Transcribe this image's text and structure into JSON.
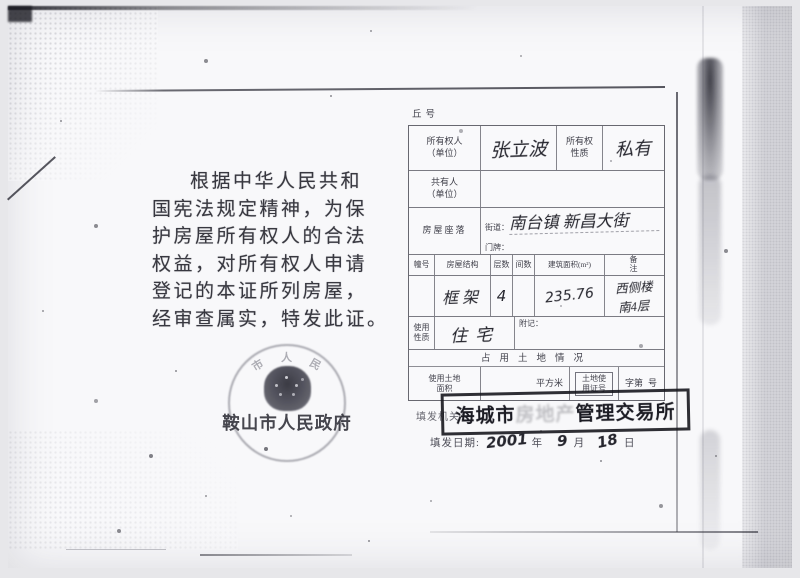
{
  "left_page": {
    "paragraph_lines": [
      "根据中华人民共和",
      "国宪法规定精神，为保",
      "护房屋所有权人的合法",
      "权益，对所有权人申请",
      "登记的本证所列房屋，",
      "经审查属实，特发此证。"
    ],
    "seal": {
      "arc_chars": [
        "市",
        "人",
        "民"
      ],
      "name": "鞍山市人民政府"
    }
  },
  "form": {
    "plot_no_label": "丘号",
    "owner": {
      "label": "所有权人（单位）",
      "value": "张立波"
    },
    "ownership_nature": {
      "label": "所有权性质",
      "value": "私有"
    },
    "co_owner": {
      "label": "共有人（单位）",
      "value": ""
    },
    "location": {
      "label": "房屋座落",
      "street_label": "街道：",
      "street_value": "南台镇 新昌大街",
      "plate_label": "门牌："
    },
    "columns": [
      "幢号",
      "房屋结构",
      "层数",
      "间数",
      "建筑面积(m²)",
      "备注"
    ],
    "building": {
      "building_no": "",
      "structure": "框架",
      "floors": "4",
      "rooms": "",
      "area": "235.76",
      "remark_line1": "西侧楼",
      "remark_line2": "南4层"
    },
    "usage": {
      "label": "使用性质",
      "value": "住宅",
      "note_label": "附记："
    },
    "land_section_title": "占用土地情况",
    "land": {
      "area_label": "使用土地面积",
      "area_value": "",
      "unit": "平方米",
      "cert_label": "土地使用证号",
      "zi_label": "字第",
      "hao_label": "号"
    }
  },
  "issue": {
    "authority_label": "填发机关：",
    "stamp_prefix": "海城市",
    "stamp_middle": "房地产",
    "stamp_suffix": "管理交易所",
    "date_label": "填发日期:",
    "year_value": "2001",
    "year_unit": "年",
    "month_value": "9",
    "month_unit": "月",
    "day_value": "18",
    "day_unit": "日"
  }
}
